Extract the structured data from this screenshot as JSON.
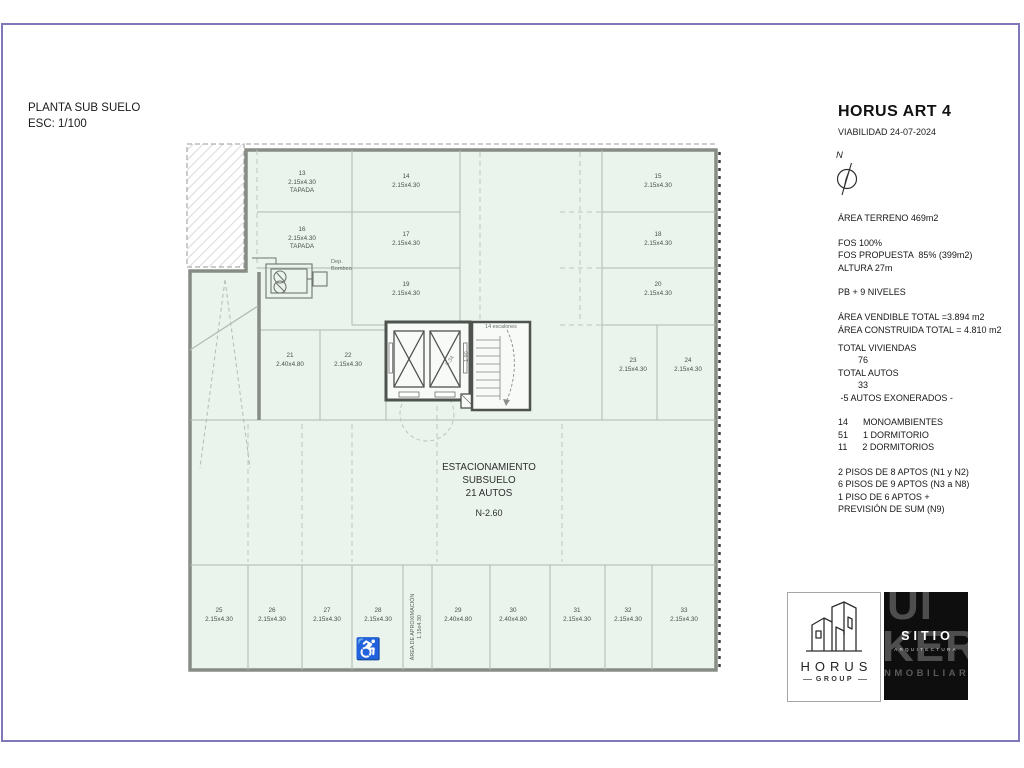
{
  "sheet": {
    "title": "PLANTA SUB SUELO\nESC: 1/100"
  },
  "header": {
    "project": "HORUS ART 4",
    "subtitle": "VIABILIDAD 24-07-2024",
    "north_label": "N"
  },
  "info": {
    "block1": "ÁREA TERRENO 469m2\n\nFOS 100%\nFOS PROPUESTA  85% (399m2)\nALTURA 27m\n\nPB + 9 NIVELES\n\nÁREA VENDIBLE TOTAL =3.894 m2\nÁREA CONSTRUIDA TOTAL = 4.810 m2",
    "block2": "TOTAL VIVIENDAS\n        76\nTOTAL AUTOS\n        33\n -5 AUTOS EXONERADOS -\n\n14      MONOAMBIENTES\n51      1 DORMITORIO\n11      2 DORMITORIOS\n\n2 PISOS DE 8 APTOS (N1 y N2)\n6 PISOS DE 9 APTOS (N3 a N8)\n1 PISO DE 6 APTOS +\nPREVISIÓN DE SUM (N9)"
  },
  "plan": {
    "center_label": "ESTACIONAMIENTO\nSUBSUELO\n21 AUTOS",
    "level_label": "N-2.60",
    "pump_room_label": "Dep.\nBombeo",
    "stairs_label": "14  escalones",
    "approach_label": "ÁREA DE APROXIMACIÓN\n1.15x4.30",
    "icon_wheelchair": "♿",
    "core_dims": {
      "w": "5.34",
      "h": "1.90"
    },
    "spots": [
      {
        "num": "13",
        "size": "2.15x4.30",
        "note": "TAPADA"
      },
      {
        "num": "14",
        "size": "2.15x4.30"
      },
      {
        "num": "15",
        "size": "2.15x4.30"
      },
      {
        "num": "16",
        "size": "2.15x4.30",
        "note": "TAPADA"
      },
      {
        "num": "17",
        "size": "2.15x4.30"
      },
      {
        "num": "18",
        "size": "2.15x4.30"
      },
      {
        "num": "19",
        "size": "2.15x4.30"
      },
      {
        "num": "20",
        "size": "2.15x4.30"
      },
      {
        "num": "21",
        "size": "2.40x4.80"
      },
      {
        "num": "22",
        "size": "2.15x4.30"
      },
      {
        "num": "23",
        "size": "2.15x4.30"
      },
      {
        "num": "24",
        "size": "2.15x4.30"
      },
      {
        "num": "25",
        "size": "2.15x4.30"
      },
      {
        "num": "26",
        "size": "2.15x4.30"
      },
      {
        "num": "27",
        "size": "2.15x4.30"
      },
      {
        "num": "28",
        "size": "2.15x4.30"
      },
      {
        "num": "29",
        "size": "2.40x4.80"
      },
      {
        "num": "30",
        "size": "2.40x4.80"
      },
      {
        "num": "31",
        "size": "2.15x4.30"
      },
      {
        "num": "32",
        "size": "2.15x4.30"
      },
      {
        "num": "33",
        "size": "2.15x4.30"
      }
    ]
  },
  "logos": {
    "horus": {
      "name": "HORUS",
      "sub": "GROUP"
    },
    "sitio": {
      "name": "SITIO",
      "sub": "ARQUITECTURA",
      "watermark_top": "UI",
      "watermark_mid": "KER",
      "watermark_bottom": "NMOBILIARI"
    }
  },
  "colors": {
    "frame": "#7e78b8",
    "plan_fill": "#eaf3ec",
    "wall": "#878d85",
    "accent_dark": "#0e0e0e"
  }
}
